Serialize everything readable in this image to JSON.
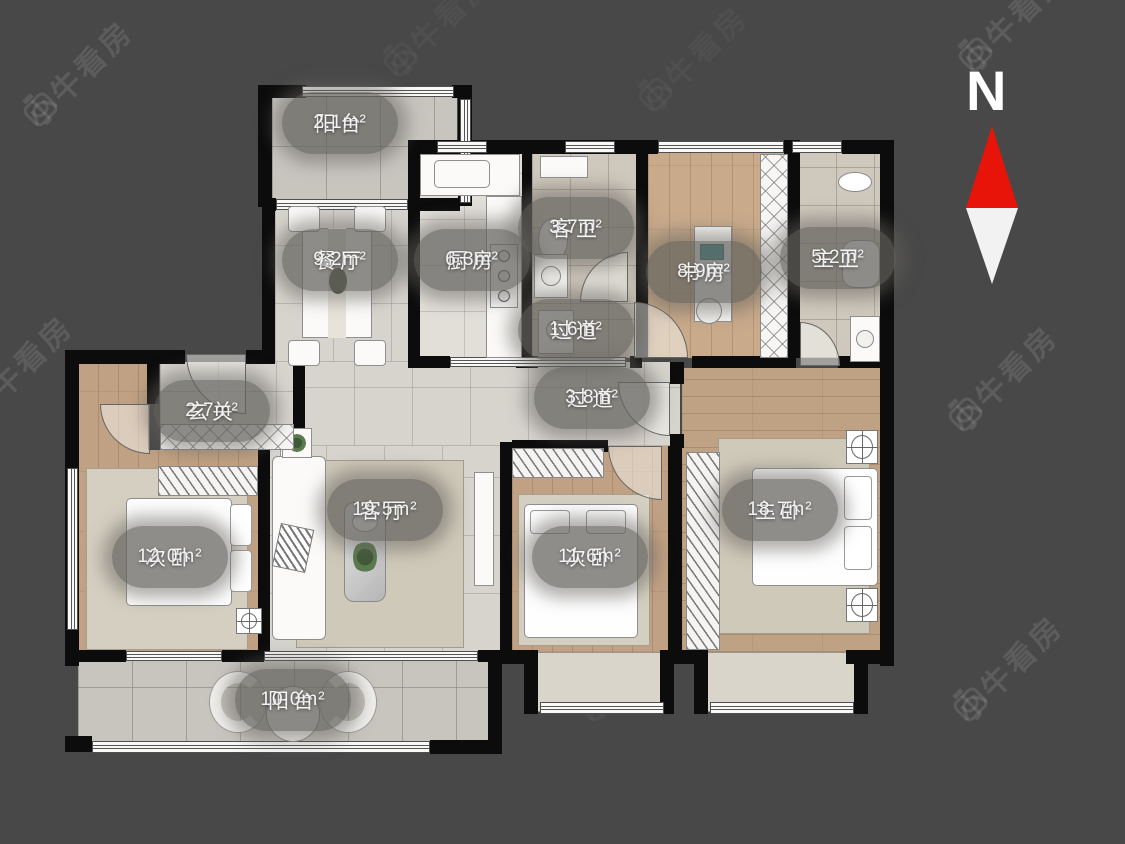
{
  "watermark": {
    "text": "小牛看房"
  },
  "compass": {
    "label": "N",
    "north_color": "#e81309"
  },
  "colors": {
    "background": "#484848",
    "wall": "#0c0c0c",
    "label_pill": "rgba(99,97,93,0.72)",
    "label_text": "#f8f8f8"
  },
  "rooms": [
    {
      "id": "balcony-top",
      "name": "阳台",
      "area": "2.1m²"
    },
    {
      "id": "dining",
      "name": "餐厅",
      "area": "9.2m²"
    },
    {
      "id": "kitchen",
      "name": "厨房",
      "area": "6.3m²"
    },
    {
      "id": "guest-bath",
      "name": "客卫",
      "area": "3.7m²"
    },
    {
      "id": "study",
      "name": "书房",
      "area": "8.9m²"
    },
    {
      "id": "master-bath",
      "name": "主卫",
      "area": "5.2m²"
    },
    {
      "id": "hallway-small",
      "name": "过道",
      "area": "1.6m²"
    },
    {
      "id": "hallway",
      "name": "过道",
      "area": "3.8m²"
    },
    {
      "id": "entry",
      "name": "玄关",
      "area": "2.7m²"
    },
    {
      "id": "bedroom-left",
      "name": "次卧",
      "area": "12.0m²"
    },
    {
      "id": "living",
      "name": "客厅",
      "area": "19.5m²"
    },
    {
      "id": "bedroom-mid",
      "name": "次卧",
      "area": "11.6m²"
    },
    {
      "id": "master-bedroom",
      "name": "主卧",
      "area": "18.7m²"
    },
    {
      "id": "balcony-bottom",
      "name": "阳台",
      "area": "10.0m²"
    }
  ]
}
